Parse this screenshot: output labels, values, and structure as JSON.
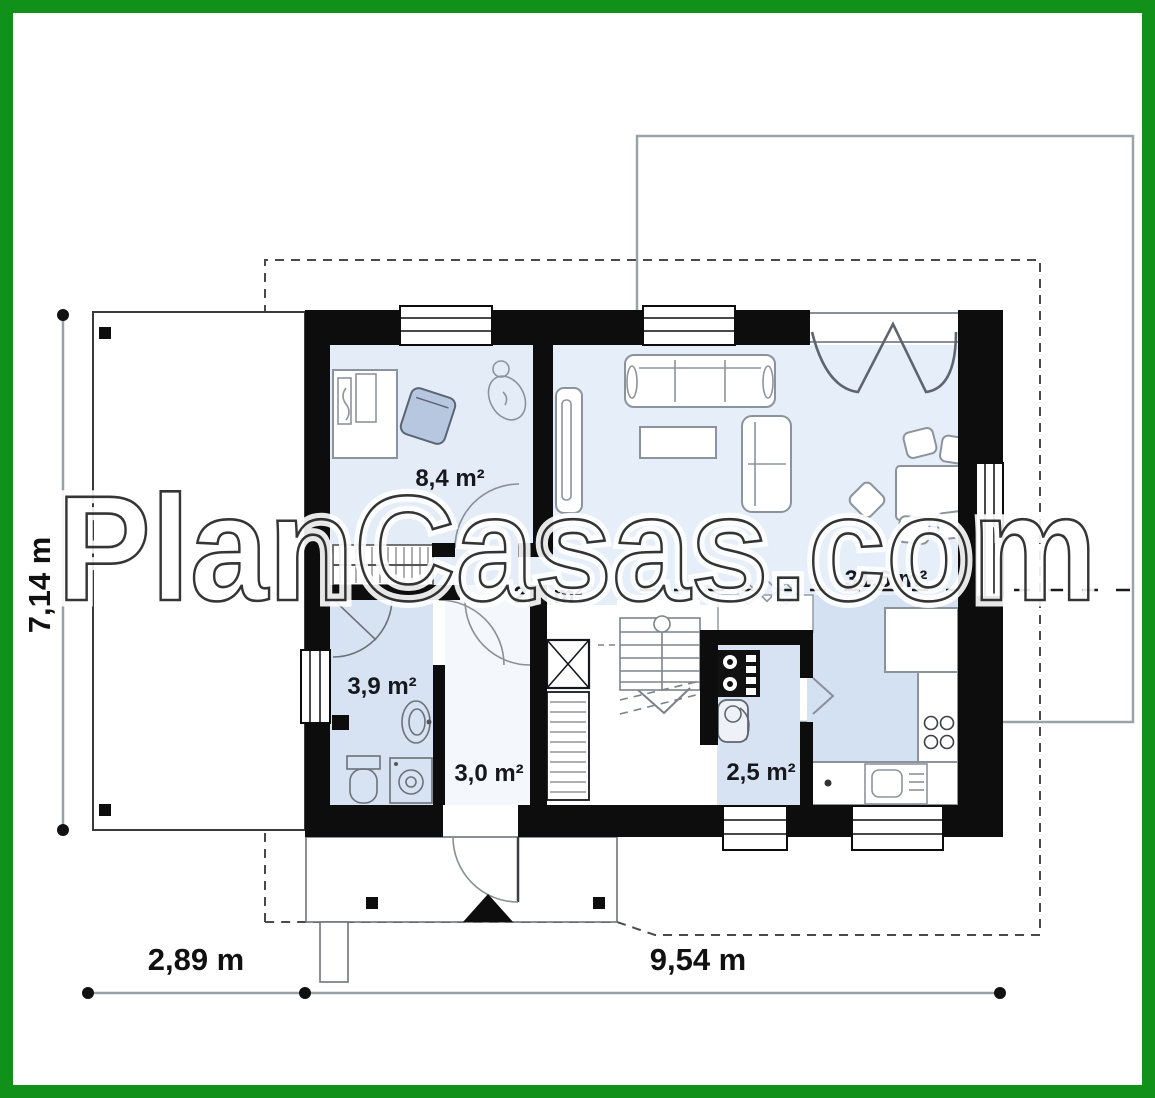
{
  "watermark": {
    "text": "PlanCasas.com"
  },
  "rooms": [
    {
      "name": "office",
      "area": "8,4 m²"
    },
    {
      "name": "wardrobe",
      "area": "2,6 m²"
    },
    {
      "name": "bathroom",
      "area": "3,9 m²"
    },
    {
      "name": "hall",
      "area": "3,0 m²"
    },
    {
      "name": "pantry",
      "area": "2,5 m²"
    },
    {
      "name": "living-room-kitchen",
      "area": "31,6 m²"
    }
  ],
  "dimensions": {
    "side_height": "7,14 m",
    "bottom_left_width": "2,89 m",
    "bottom_right_width": "9,54 m"
  },
  "colors": {
    "border_green": "#12911a",
    "wall_black": "#0d0d0d",
    "floor_blue_light": "#e4ecf8",
    "floor_blue_medium": "#d7e3f2",
    "site_line_gray": "#9aa3a8"
  }
}
